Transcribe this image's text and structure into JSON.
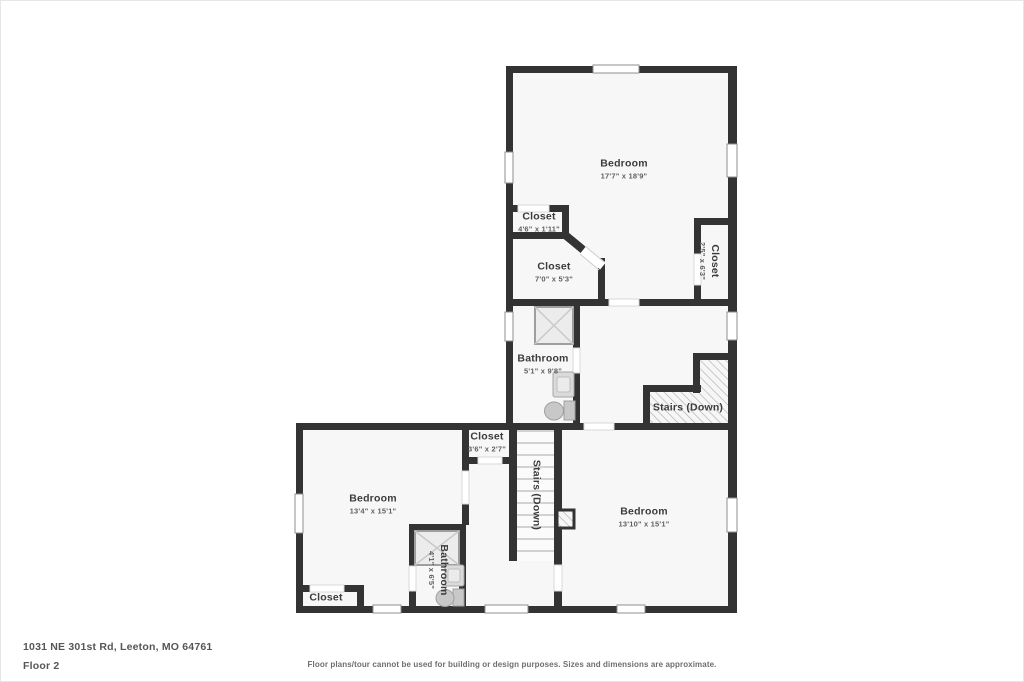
{
  "page": {
    "address": "1031 NE 301st Rd, Leeton, MO 64761",
    "floor_label": "Floor 2",
    "disclaimer": "Floor plans/tour cannot be used for building or design purposes. Sizes and dimensions are approximate."
  },
  "rooms": {
    "bedroom_top": {
      "name": "Bedroom",
      "dims": "17'7\" x 18'9\""
    },
    "closet_top_small": {
      "name": "Closet",
      "dims": "4'6\" x 1'11\""
    },
    "closet_top_mid": {
      "name": "Closet",
      "dims": "7'0\" x 5'3\""
    },
    "closet_top_right": {
      "name": "Closet",
      "dims": "2'5\" x 6'3\""
    },
    "bathroom_upper": {
      "name": "Bathroom",
      "dims": "5'1\" x 9'8\""
    },
    "stairs_upper": {
      "name": "Stairs (Down)"
    },
    "closet_hall": {
      "name": "Closet",
      "dims": "3'6\" x 2'7\""
    },
    "bedroom_left": {
      "name": "Bedroom",
      "dims": "13'4\" x 15'1\""
    },
    "bathroom_lower": {
      "name": "Bathroom",
      "dims": "4'1\" x 6'5\""
    },
    "stairs_lower": {
      "name": "Stairs (Down)"
    },
    "bedroom_right": {
      "name": "Bedroom",
      "dims": "13'10\" x 15'1\""
    },
    "closet_bottom_left": {
      "name": "Closet"
    }
  },
  "colors": {
    "wall": "#333333",
    "floor": "#f7f7f7",
    "fixture": "#c8c8c8",
    "hatch": "#b4b4b4",
    "window_frame": "#8f8f8f"
  }
}
